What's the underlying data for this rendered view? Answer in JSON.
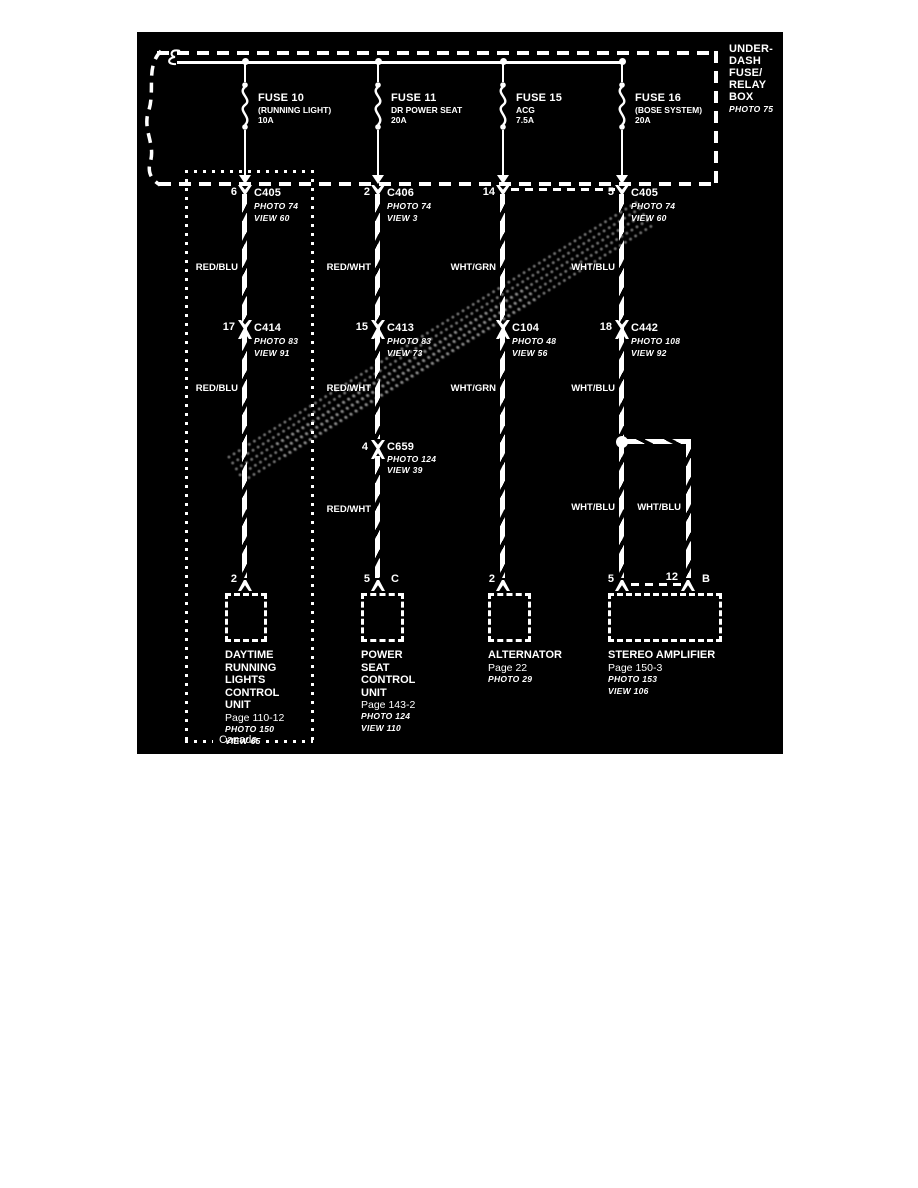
{
  "colors": {
    "page_background": "#ffffff",
    "diagram_background": "#000000",
    "line_color": "#ffffff"
  },
  "fuse_box": {
    "label_lines": [
      "UNDER-",
      "DASH",
      "FUSE/",
      "RELAY",
      "BOX"
    ],
    "photo": "PHOTO 75"
  },
  "canada_label": "Canada",
  "columns": [
    {
      "fuse": {
        "name": "FUSE 10",
        "desc": "(RUNNING LIGHT)",
        "amps": "10A"
      },
      "conn1": {
        "pin": "6",
        "name": "C405",
        "photo": "PHOTO 74",
        "view": "VIEW 60"
      },
      "wire_a": "RED/BLU",
      "conn2": {
        "pin": "17",
        "name": "C414",
        "photo": "PHOTO 83",
        "view": "VIEW 91"
      },
      "wire_b": "RED/BLU",
      "bottom_pin": "2",
      "component": {
        "name_lines": [
          "DAYTIME",
          "RUNNING",
          "LIGHTS",
          "CONTROL",
          "UNIT"
        ],
        "page": "Page 110-12",
        "photo": "PHOTO 150",
        "view": "VIEW 65"
      }
    },
    {
      "fuse": {
        "name": "FUSE 11",
        "desc": "DR POWER SEAT",
        "amps": "20A"
      },
      "conn1": {
        "pin": "2",
        "name": "C406",
        "photo": "PHOTO 74",
        "view": "VIEW 3"
      },
      "wire_a": "RED/WHT",
      "conn2": {
        "pin": "15",
        "name": "C413",
        "photo": "PHOTO 83",
        "view": "VIEW 73"
      },
      "wire_b": "RED/WHT",
      "conn3": {
        "pin": "4",
        "name": "C659",
        "photo": "PHOTO 124",
        "view": "VIEW 39"
      },
      "wire_c": "RED/WHT",
      "bottom_pin": "5",
      "bottom_terminal": "C",
      "component": {
        "name_lines": [
          "POWER",
          "SEAT",
          "CONTROL",
          "UNIT"
        ],
        "page": "Page 143-2",
        "photo": "PHOTO 124",
        "view": "VIEW 110"
      }
    },
    {
      "fuse": {
        "name": "FUSE 15",
        "desc": "ACG",
        "amps": "7.5A"
      },
      "conn1": {
        "pin": "14",
        "name": "",
        "photo": "",
        "view": ""
      },
      "wire_a": "WHT/GRN",
      "conn2": {
        "pin": "",
        "name": "C104",
        "photo": "PHOTO 48",
        "view": "VIEW 56"
      },
      "wire_b": "WHT/GRN",
      "bottom_pin": "2",
      "component": {
        "name_lines": [
          "ALTERNATOR"
        ],
        "page": "Page 22",
        "photo": "PHOTO 29",
        "view": ""
      }
    },
    {
      "fuse": {
        "name": "FUSE 16",
        "desc": "(BOSE SYSTEM)",
        "amps": "20A"
      },
      "conn1": {
        "pin": "5",
        "name": "C405",
        "photo": "PHOTO 74",
        "view": "VIEW 60"
      },
      "wire_a": "WHT/BLU",
      "conn2": {
        "pin": "18",
        "name": "C442",
        "photo": "PHOTO 108",
        "view": "VIEW 92"
      },
      "wire_b": "WHT/BLU",
      "branch_wire_left": "WHT/BLU",
      "branch_wire_right": "WHT/BLU",
      "bottom_pin": "5",
      "bottom_pin2": "12",
      "bottom_terminal": "B",
      "component": {
        "name_lines": [
          "STEREO AMPLIFIER"
        ],
        "page": "Page 150-3",
        "photo": "PHOTO 153",
        "view": "VIEW 106"
      }
    }
  ]
}
